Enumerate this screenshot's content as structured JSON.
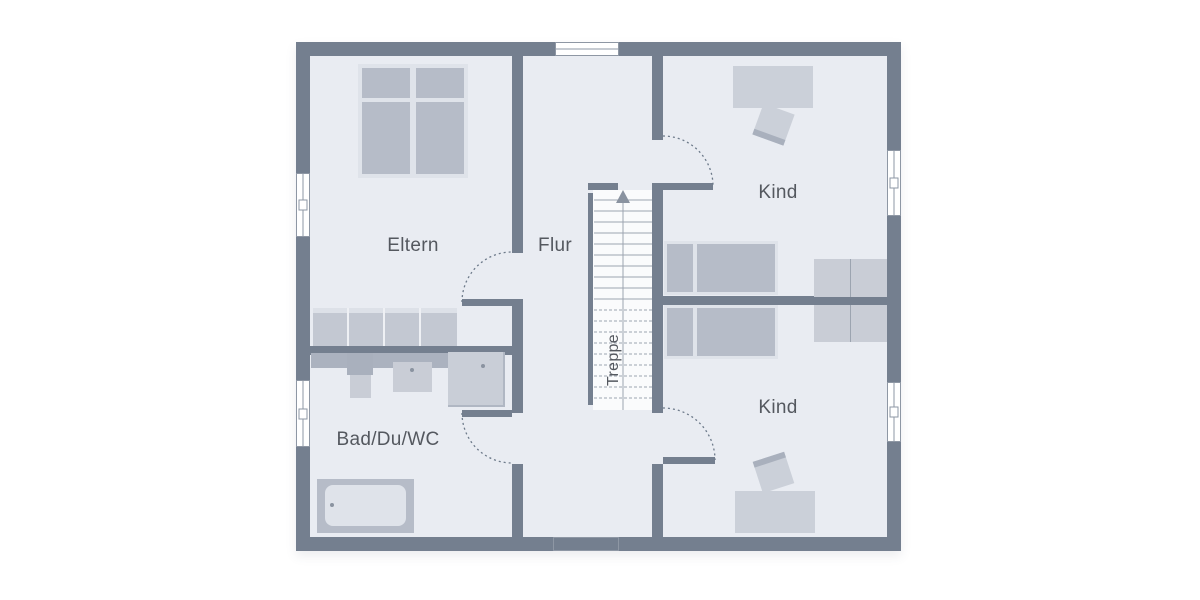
{
  "plan": {
    "kind": "floorplan",
    "rooms": [
      {
        "id": "eltern",
        "label": "Eltern"
      },
      {
        "id": "flur",
        "label": "Flur"
      },
      {
        "id": "kind_top",
        "label": "Kind"
      },
      {
        "id": "kind_bottom",
        "label": "Kind"
      },
      {
        "id": "bad",
        "label": "Bad/Du/WC"
      },
      {
        "id": "treppe",
        "label": "Treppe"
      }
    ],
    "stairs": {
      "direction_icon": "arrow-up",
      "label": "Treppe"
    },
    "window_count": 6,
    "door_count": 4
  },
  "colors": {
    "background": "#ffffff",
    "wall": "#747f8f",
    "floor": "#e9ecf2",
    "stairfloor": "#fafbfc",
    "furnlight": "#cbd0d9",
    "furnmid": "#b6bcc8",
    "frame": "#dfe3ea",
    "counter": "#abb2bf",
    "fixture": "#c9cdd6",
    "line": "#9ca4b0",
    "arc": "#6d7a8a",
    "winframe": "#8e97a4",
    "text": "#54585f"
  }
}
